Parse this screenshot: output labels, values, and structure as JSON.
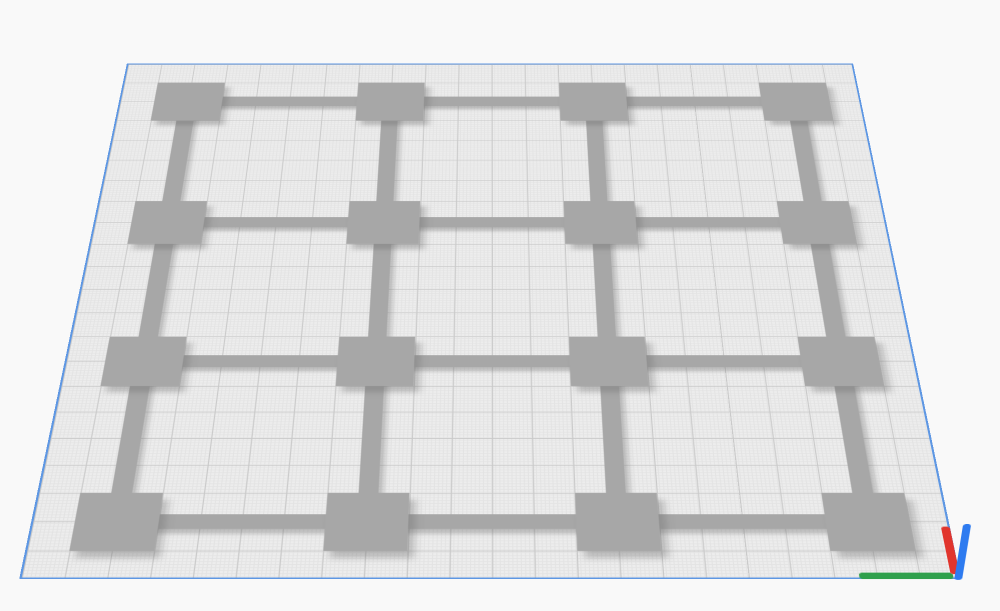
{
  "scene": {
    "description": "3D printer slicer build-plate viewport showing a bed-level calibration grid model",
    "background_color": "#f9f9f9"
  },
  "build_plate": {
    "size_mm": 220,
    "grid_minor_mm": 1,
    "grid_major_mm": 10,
    "surface_color": "#ededed",
    "grid_minor_color": "#e3e3e3",
    "grid_major_color": "#c9c9c9",
    "edge_color": "#5e97e3",
    "vertical_edge_color": "#4f8ee8",
    "vertical_edge_style": "dashed"
  },
  "model": {
    "name": "bed-level-calibration-grid",
    "grid_rows": 4,
    "grid_cols": 4,
    "square_size_mm": 20,
    "bar_width_mm": 5,
    "row_positions_mm": [
      20,
      80,
      140,
      200
    ],
    "col_positions_mm": [
      20,
      80,
      140,
      200
    ],
    "color": "#a7a7a7",
    "shadow_color": "rgba(110,110,110,0.38)"
  },
  "axes_indicator": {
    "corner": "front-right",
    "x_axis": {
      "color": "#2fa04c",
      "length_mm": 22,
      "thickness_px": 8
    },
    "y_axis": {
      "color": "#e1352d",
      "length_mm": 16,
      "thickness_px": 8
    },
    "z_axis": {
      "color": "#2e7bf0",
      "length_mm": 18,
      "thickness_px": 7
    }
  }
}
